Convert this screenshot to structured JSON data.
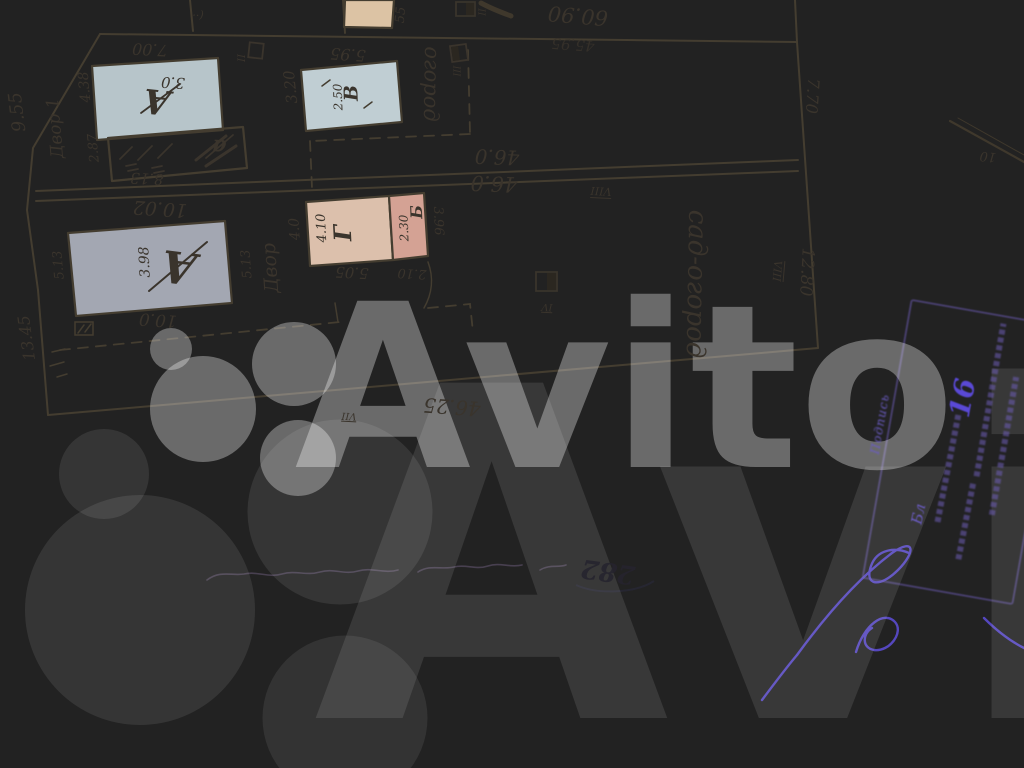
{
  "colors": {
    "ink": "#3a342c",
    "ink2": "#4c4537",
    "dark": "#26242e",
    "purple": "#6b5cc4",
    "purple2": "#5a49d6",
    "wm": "rgba(255,255,255,0.33)",
    "wm2": "rgba(255,255,255,0.10)",
    "fill_blue_light": "#b7c5ca",
    "fill_blue": "#c0ced3",
    "fill_gray": "#a3a7b2",
    "fill_pink": "#dcc0ac",
    "fill_salmon": "#d4a294",
    "fill_tan": "#dcc3a4"
  },
  "watermark": {
    "brand": "Avito",
    "texts": [
      {
        "n": "watermark-text",
        "t": "Avito",
        "x": 625,
        "y": 388,
        "r": 0,
        "s": 228,
        "c": "wm",
        "f": "brand",
        "w": 700
      },
      {
        "n": "watermark-text-giant",
        "t": "Avito",
        "x": 980,
        "y": 560,
        "r": 0,
        "s": 460,
        "c": "wm2",
        "f": "brand",
        "w": 700
      }
    ],
    "dots": [
      {
        "n": "wm-dot-1",
        "x": 171,
        "y": 349,
        "d": 42,
        "o": 0.32
      },
      {
        "n": "wm-dot-2",
        "x": 203,
        "y": 409,
        "d": 106,
        "o": 0.33
      },
      {
        "n": "wm-dot-3",
        "x": 294,
        "y": 364,
        "d": 84,
        "o": 0.33
      },
      {
        "n": "wm-dot-4",
        "x": 298,
        "y": 458,
        "d": 76,
        "o": 0.32
      },
      {
        "n": "wm-dot-giant-1",
        "x": 104,
        "y": 474,
        "d": 90,
        "o": 0.09
      },
      {
        "n": "wm-dot-giant-2",
        "x": 140,
        "y": 610,
        "d": 230,
        "o": 0.09
      },
      {
        "n": "wm-dot-giant-3",
        "x": 340,
        "y": 512,
        "d": 185,
        "o": 0.085
      },
      {
        "n": "wm-dot-giant-4",
        "x": 345,
        "y": 718,
        "d": 165,
        "o": 0.08
      }
    ]
  },
  "plan": {
    "top_edge_labels": [
      {
        "n": "dim-60-90",
        "t": "60.90",
        "x": 578,
        "y": 15,
        "r": 185,
        "s": 21
      },
      {
        "n": "dim-45-95",
        "t": "45.95",
        "x": 573,
        "y": 44,
        "r": 184,
        "s": 15,
        "o": 0.8
      },
      {
        "n": "mark-55",
        "t": "55",
        "x": 401,
        "y": 15,
        "r": -85,
        "s": 13
      },
      {
        "n": "mark-parens",
        "t": "(··",
        "x": 198,
        "y": 15,
        "r": 183,
        "s": 11
      },
      {
        "n": "mark-square-top",
        "t": "II",
        "x": 484,
        "y": 12,
        "r": -90,
        "s": 9
      }
    ],
    "upper_strip_labels": [
      {
        "n": "dim-7-00",
        "t": "7.00",
        "x": 150,
        "y": 49,
        "r": 183,
        "s": 16
      },
      {
        "n": "dim-9-55",
        "t": "9.55",
        "x": 18,
        "y": 112,
        "r": -97,
        "s": 18
      },
      {
        "n": "label-dvor-1",
        "t": "Двор 1",
        "x": 56,
        "y": 128,
        "r": -95,
        "s": 17
      },
      {
        "n": "dim-4-38",
        "t": "4.38",
        "x": 85,
        "y": 87,
        "r": -95,
        "s": 14
      },
      {
        "n": "building-a-upper-letter",
        "t": "А",
        "x": 157,
        "y": 101,
        "r": 186,
        "s": 34,
        "w": 700
      },
      {
        "n": "building-a-upper-height",
        "t": "3.0",
        "x": 173,
        "y": 82,
        "r": 183,
        "s": 15
      },
      {
        "n": "dim-2-87",
        "t": "2.87",
        "x": 94,
        "y": 148,
        "r": -95,
        "s": 13
      },
      {
        "n": "annex-a-letter",
        "t": "а",
        "x": 219,
        "y": 147,
        "r": 185,
        "s": 22,
        "w": 700
      },
      {
        "n": "dim-8-13",
        "t": "8.13",
        "x": 147,
        "y": 178,
        "r": 183,
        "s": 15
      },
      {
        "n": "mark-ii",
        "t": "II",
        "x": 243,
        "y": 58,
        "r": -90,
        "s": 10
      },
      {
        "n": "dim-5-95",
        "t": "5.95",
        "x": 348,
        "y": 54,
        "r": 184,
        "s": 16
      },
      {
        "n": "dim-3-20",
        "t": "3.20",
        "x": 291,
        "y": 87,
        "r": -96,
        "s": 15
      },
      {
        "n": "building-v-letter",
        "t": "В",
        "x": 352,
        "y": 93,
        "r": -92,
        "s": 19,
        "w": 700
      },
      {
        "n": "building-v-height",
        "t": "2.50",
        "x": 338,
        "y": 97,
        "r": -92,
        "s": 12
      },
      {
        "n": "area-ogorod",
        "t": "огород",
        "x": 431,
        "y": 84,
        "r": 91,
        "s": 21
      },
      {
        "n": "mark-iii",
        "t": "III",
        "x": 459,
        "y": 71,
        "r": -90,
        "s": 9
      },
      {
        "n": "dim-46-0-upper",
        "t": "46.0",
        "x": 497,
        "y": 157,
        "r": 182,
        "s": 20
      },
      {
        "n": "dim-46-0-lower",
        "t": "46.0",
        "x": 494,
        "y": 183,
        "r": 182,
        "s": 21
      }
    ],
    "lower_strip_labels": [
      {
        "n": "mark-viii-top",
        "t": "VIII",
        "x": 601,
        "y": 191,
        "r": 183,
        "s": 11,
        "dec": 1
      },
      {
        "n": "dim-10-02",
        "t": "10.02",
        "x": 160,
        "y": 208,
        "r": 184,
        "s": 19
      },
      {
        "n": "dim-4-0",
        "t": "4.0",
        "x": 295,
        "y": 229,
        "r": -94,
        "s": 14
      },
      {
        "n": "building-g-dim",
        "t": "4.10",
        "x": 322,
        "y": 228,
        "r": -93,
        "s": 13
      },
      {
        "n": "building-g-letter",
        "t": "Г",
        "x": 343,
        "y": 233,
        "r": -93,
        "s": 24,
        "w": 700
      },
      {
        "n": "building-b-letter",
        "t": "Б",
        "x": 417,
        "y": 212,
        "r": -92,
        "s": 16,
        "w": 700
      },
      {
        "n": "building-b-dim",
        "t": "2.30",
        "x": 404,
        "y": 228,
        "r": -92,
        "s": 12
      },
      {
        "n": "dim-3-96",
        "t": "3.96",
        "x": 438,
        "y": 221,
        "r": 88,
        "s": 13
      },
      {
        "n": "label-dvor-2",
        "t": "Двор",
        "x": 271,
        "y": 268,
        "r": -94,
        "s": 19
      },
      {
        "n": "dim-5-13-dvor",
        "t": "5.13",
        "x": 247,
        "y": 264,
        "r": -94,
        "s": 13
      },
      {
        "n": "dim-5-05",
        "t": "5.05",
        "x": 352,
        "y": 272,
        "r": 183,
        "s": 15
      },
      {
        "n": "dim-2-10",
        "t": "2.10",
        "x": 412,
        "y": 273,
        "r": 183,
        "s": 13
      },
      {
        "n": "building-a-lower-letter",
        "t": "А",
        "x": 179,
        "y": 266,
        "r": 187,
        "s": 44,
        "w": 700
      },
      {
        "n": "building-a-lower-dim",
        "t": "3.98",
        "x": 145,
        "y": 262,
        "r": -93,
        "s": 14
      },
      {
        "n": "dim-10-0",
        "t": "10.0",
        "x": 158,
        "y": 319,
        "r": 184,
        "s": 17
      },
      {
        "n": "dim-5-13-left",
        "t": "5.13",
        "x": 59,
        "y": 265,
        "r": -95,
        "s": 13
      },
      {
        "n": "dim-13-45",
        "t": "13.45",
        "x": 27,
        "y": 338,
        "r": -98,
        "s": 16
      },
      {
        "n": "area-sad-ogorod",
        "t": "сад-огород",
        "x": 696,
        "y": 284,
        "r": 91,
        "s": 26
      },
      {
        "n": "mark-viii-right",
        "t": "VIII",
        "x": 777,
        "y": 271,
        "r": 95,
        "s": 11,
        "dec": 1
      },
      {
        "n": "dim-12-80",
        "t": "12.80",
        "x": 806,
        "y": 272,
        "r": 93,
        "s": 17
      },
      {
        "n": "mark-iv",
        "t": "IV",
        "x": 547,
        "y": 306,
        "r": 183,
        "s": 10,
        "dec": 1
      },
      {
        "n": "dim-46-25",
        "t": "46.25",
        "x": 452,
        "y": 407,
        "r": 184,
        "s": 20
      },
      {
        "n": "mark-vii",
        "t": "VII",
        "x": 349,
        "y": 415,
        "r": 183,
        "s": 10,
        "dec": 1
      },
      {
        "n": "dim-7-70",
        "t": "7.70",
        "x": 812,
        "y": 96,
        "r": 94,
        "s": 16
      },
      {
        "n": "mark-10",
        "t": "10",
        "x": 988,
        "y": 156,
        "r": 185,
        "s": 13
      }
    ]
  },
  "notes": {
    "illegible_faint_pencil_note": true,
    "labels": [
      {
        "n": "scribble-282",
        "t": "282",
        "x": 608,
        "y": 571,
        "r": 188,
        "s": 26,
        "c": "dark",
        "w": 700,
        "o": 0.9
      }
    ]
  },
  "stamp": {
    "text_legible": false,
    "labels": [
      {
        "n": "stamp-number",
        "t": "16",
        "x": 963,
        "y": 398,
        "r": -80,
        "s": 28,
        "c": "purple2",
        "cls": "p",
        "w": 700
      },
      {
        "n": "stamp-podpis-label",
        "t": "Подпись",
        "x": 880,
        "y": 424,
        "r": -80,
        "s": 12,
        "c": "purple",
        "cls": "blurry"
      },
      {
        "n": "stamp-bl-note",
        "t": "Бл",
        "x": 919,
        "y": 514,
        "r": -78,
        "s": 15,
        "c": "purple",
        "cls": "p"
      }
    ],
    "text_bars": [
      {
        "n": "stamp-text-line-1",
        "x": 990,
        "y": 400,
        "len": 155,
        "r": -80
      },
      {
        "n": "stamp-text-line-2",
        "x": 1004,
        "y": 446,
        "len": 140,
        "r": -80
      },
      {
        "n": "stamp-text-line-3",
        "x": 948,
        "y": 468,
        "len": 110,
        "r": -79
      },
      {
        "n": "stamp-text-line-4",
        "x": 966,
        "y": 520,
        "len": 80,
        "r": -79
      }
    ]
  }
}
